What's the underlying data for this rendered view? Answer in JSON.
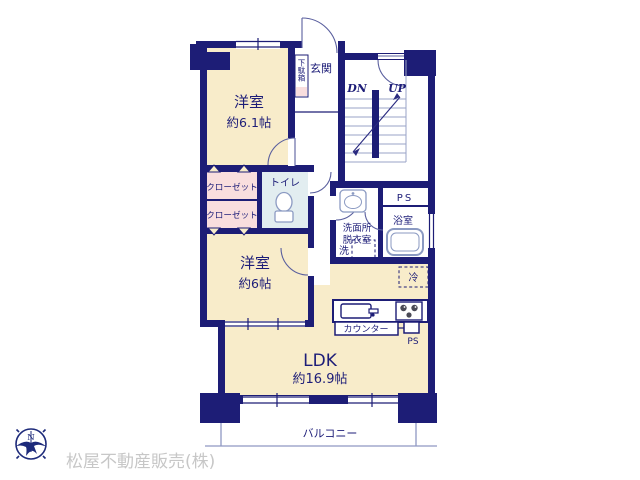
{
  "plan": {
    "rooms": {
      "bedroom1": {
        "name": "洋室",
        "size": "約6.1帖"
      },
      "bedroom2": {
        "name": "洋室",
        "size": "約6帖"
      },
      "ldk": {
        "name": "LDK",
        "size": "約16.9帖"
      },
      "entrance": {
        "label": "玄関"
      },
      "shoe_cabinet": {
        "label": "下駄箱"
      },
      "closet_upper": {
        "label": "クローゼット"
      },
      "closet_lower": {
        "label": "クローゼット"
      },
      "toilet": {
        "label": "トイレ"
      },
      "washroom": {
        "label_line1": "洗面所",
        "label_line2": "脱衣室"
      },
      "washer": {
        "label": "洗"
      },
      "bath": {
        "label": "浴室"
      },
      "fridge": {
        "label": "冷"
      },
      "counter": {
        "label": "カウンター"
      },
      "balcony": {
        "label": "バルコニー"
      },
      "ps_upper": {
        "label": "PS"
      },
      "ps_lower": {
        "label": "PS"
      }
    },
    "stairs": {
      "down": "DN",
      "up": "UP"
    }
  },
  "branding": {
    "company": "松屋不動産販売(株)",
    "compass_north": "N"
  },
  "colors": {
    "wall_navy": "#1d1d76",
    "room_cream": "#f8ecca",
    "closet_pink": "#f9dede",
    "toilet_blue": "#e2edf0",
    "fixture_line": "#8b9ac2",
    "stair_tread": "#9aa3c7",
    "balcony_line": "#8f98c2",
    "watermark_gray": "#c7c7c7"
  }
}
